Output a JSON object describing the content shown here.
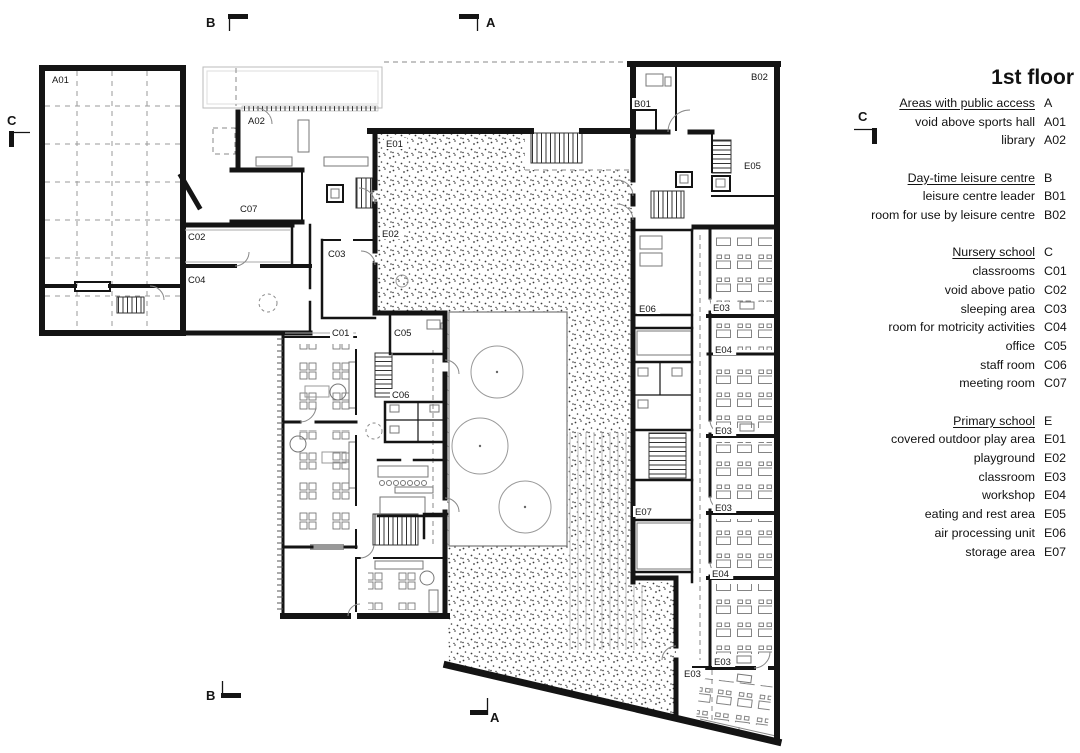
{
  "legend": {
    "title": "1st floor",
    "groups": [
      {
        "header": "Areas with public access",
        "code": "A",
        "items": [
          {
            "label": "void above sports hall",
            "code": "A01"
          },
          {
            "label": "library",
            "code": "A02"
          }
        ]
      },
      {
        "header": "Day-time leisure centre",
        "code": "B",
        "items": [
          {
            "label": "leisure centre leader",
            "code": "B01"
          },
          {
            "label": "room for use by leisure centre",
            "code": "B02"
          }
        ]
      },
      {
        "header": "Nursery school",
        "code": "C",
        "items": [
          {
            "label": "classrooms",
            "code": "C01"
          },
          {
            "label": "void above patio",
            "code": "C02"
          },
          {
            "label": "sleeping area",
            "code": "C03"
          },
          {
            "label": "room for motricity activities",
            "code": "C04"
          },
          {
            "label": "office",
            "code": "C05"
          },
          {
            "label": "staff room",
            "code": "C06"
          },
          {
            "label": "meeting room",
            "code": "C07"
          }
        ]
      },
      {
        "header": "Primary school",
        "code": "E",
        "items": [
          {
            "label": "covered outdoor play area",
            "code": "E01"
          },
          {
            "label": "playground",
            "code": "E02"
          },
          {
            "label": "classroom",
            "code": "E03"
          },
          {
            "label": "workshop",
            "code": "E04"
          },
          {
            "label": "eating and rest area",
            "code": "E05"
          },
          {
            "label": "air processing unit",
            "code": "E06"
          },
          {
            "label": "storage area",
            "code": "E07"
          }
        ]
      }
    ]
  },
  "plan": {
    "labels": [
      {
        "t": "A01",
        "x": 52,
        "y": 83
      },
      {
        "t": "A02",
        "x": 248,
        "y": 124
      },
      {
        "t": "C07",
        "x": 240,
        "y": 212
      },
      {
        "t": "C02",
        "x": 188,
        "y": 240
      },
      {
        "t": "C03",
        "x": 328,
        "y": 257
      },
      {
        "t": "C04",
        "x": 188,
        "y": 283
      },
      {
        "t": "C01",
        "x": 332,
        "y": 336
      },
      {
        "t": "C05",
        "x": 394,
        "y": 336
      },
      {
        "t": "C06",
        "x": 392,
        "y": 398
      },
      {
        "t": "E01",
        "x": 386,
        "y": 147
      },
      {
        "t": "E02",
        "x": 382,
        "y": 237
      },
      {
        "t": "B01",
        "x": 634,
        "y": 107
      },
      {
        "t": "B02",
        "x": 751,
        "y": 80
      },
      {
        "t": "E05",
        "x": 744,
        "y": 169
      },
      {
        "t": "E06",
        "x": 639,
        "y": 312
      },
      {
        "t": "E03",
        "x": 713,
        "y": 311
      },
      {
        "t": "E04",
        "x": 715,
        "y": 353
      },
      {
        "t": "E03",
        "x": 715,
        "y": 434
      },
      {
        "t": "E03",
        "x": 715,
        "y": 511
      },
      {
        "t": "E04",
        "x": 712,
        "y": 577
      },
      {
        "t": "E03",
        "x": 714,
        "y": 665
      },
      {
        "t": "E07",
        "x": 635,
        "y": 515
      },
      {
        "t": "E03",
        "x": 684,
        "y": 677
      }
    ],
    "markers": [
      {
        "letter": "B",
        "tx": 206,
        "ty": 27,
        "bar": [
          228,
          14,
          20,
          5
        ],
        "line": [
          229.5,
          14,
          229.5,
          31
        ]
      },
      {
        "letter": "A",
        "tx": 486,
        "ty": 27,
        "bar": [
          459,
          14,
          20,
          5
        ],
        "line": [
          477.5,
          14,
          477.5,
          31
        ]
      },
      {
        "letter": "C",
        "tx": 7,
        "ty": 125,
        "bar": [
          9,
          131,
          5,
          16
        ],
        "line": [
          9,
          132.5,
          30,
          132.5
        ]
      },
      {
        "letter": "C",
        "tx": 858,
        "ty": 121,
        "bar": [
          872,
          128,
          5,
          16
        ],
        "line": [
          854,
          129.5,
          877,
          129.5
        ]
      },
      {
        "letter": "B",
        "tx": 206,
        "ty": 700,
        "bar": [
          221,
          693,
          20,
          5
        ],
        "line": [
          222.5,
          681,
          222.5,
          693
        ]
      },
      {
        "letter": "A",
        "tx": 490,
        "ty": 722,
        "bar": [
          470,
          710,
          18,
          5
        ],
        "line": [
          487.5,
          698,
          487.5,
          715
        ]
      }
    ]
  },
  "colors": {
    "ink": "#141414",
    "muted": "#888888",
    "paper": "#ffffff"
  }
}
